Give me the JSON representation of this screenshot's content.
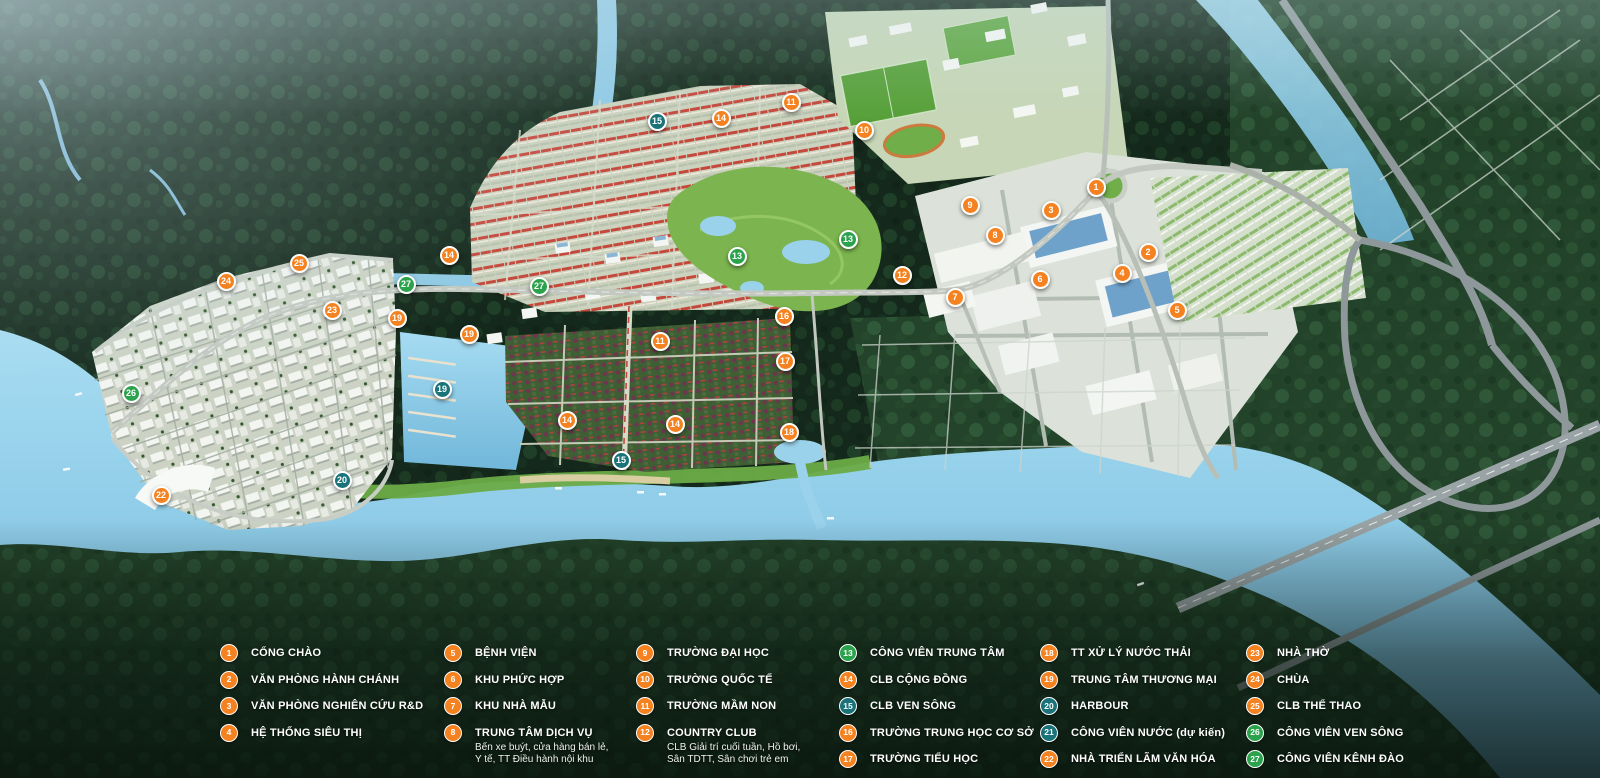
{
  "palette": {
    "orange": "#F58220",
    "green": "#2BA24C",
    "teal": "#1A7379",
    "water": "#8FC9E6",
    "forest_dark": "#16301F",
    "forest_mid": "#23432A"
  },
  "markers": [
    {
      "num": "1",
      "x": 1096,
      "y": 187,
      "color": "orange"
    },
    {
      "num": "2",
      "x": 1148,
      "y": 252,
      "color": "orange"
    },
    {
      "num": "3",
      "x": 1051,
      "y": 210,
      "color": "orange"
    },
    {
      "num": "4",
      "x": 1122,
      "y": 273,
      "color": "orange"
    },
    {
      "num": "5",
      "x": 1177,
      "y": 310,
      "color": "orange"
    },
    {
      "num": "6",
      "x": 1040,
      "y": 279,
      "color": "orange"
    },
    {
      "num": "7",
      "x": 955,
      "y": 297,
      "color": "orange"
    },
    {
      "num": "8",
      "x": 995,
      "y": 235,
      "color": "orange"
    },
    {
      "num": "9",
      "x": 970,
      "y": 205,
      "color": "orange"
    },
    {
      "num": "10",
      "x": 864,
      "y": 130,
      "color": "orange"
    },
    {
      "num": "11",
      "x": 791,
      "y": 102,
      "color": "orange"
    },
    {
      "num": "11",
      "x": 660,
      "y": 341,
      "color": "orange"
    },
    {
      "num": "12",
      "x": 902,
      "y": 275,
      "color": "orange"
    },
    {
      "num": "13",
      "x": 848,
      "y": 239,
      "color": "green"
    },
    {
      "num": "13",
      "x": 737,
      "y": 256,
      "color": "green"
    },
    {
      "num": "14",
      "x": 721,
      "y": 118,
      "color": "orange"
    },
    {
      "num": "14",
      "x": 449,
      "y": 255,
      "color": "orange"
    },
    {
      "num": "14",
      "x": 567,
      "y": 420,
      "color": "orange"
    },
    {
      "num": "14",
      "x": 675,
      "y": 424,
      "color": "orange"
    },
    {
      "num": "15",
      "x": 657,
      "y": 121,
      "color": "teal"
    },
    {
      "num": "15",
      "x": 621,
      "y": 460,
      "color": "teal"
    },
    {
      "num": "16",
      "x": 784,
      "y": 316,
      "color": "orange"
    },
    {
      "num": "17",
      "x": 785,
      "y": 361,
      "color": "orange"
    },
    {
      "num": "18",
      "x": 789,
      "y": 432,
      "color": "orange"
    },
    {
      "num": "19",
      "x": 397,
      "y": 318,
      "color": "orange"
    },
    {
      "num": "19",
      "x": 469,
      "y": 334,
      "color": "orange"
    },
    {
      "num": "19",
      "x": 442,
      "y": 389,
      "color": "teal"
    },
    {
      "num": "20",
      "x": 342,
      "y": 480,
      "color": "teal"
    },
    {
      "num": "22",
      "x": 161,
      "y": 495,
      "color": "orange"
    },
    {
      "num": "23",
      "x": 332,
      "y": 310,
      "color": "orange"
    },
    {
      "num": "24",
      "x": 226,
      "y": 281,
      "color": "orange"
    },
    {
      "num": "25",
      "x": 299,
      "y": 263,
      "color": "orange"
    },
    {
      "num": "26",
      "x": 131,
      "y": 393,
      "color": "green"
    },
    {
      "num": "27",
      "x": 406,
      "y": 284,
      "color": "green"
    },
    {
      "num": "27",
      "x": 539,
      "y": 286,
      "color": "green"
    }
  ],
  "legend": {
    "column_x": [
      220,
      444,
      636,
      839,
      1040,
      1246
    ],
    "columns": [
      {
        "items": [
          {
            "num": "1",
            "label": "CỔNG CHÀO",
            "color": "orange"
          },
          {
            "num": "2",
            "label": "VĂN PHÒNG HÀNH CHÁNH",
            "color": "orange"
          },
          {
            "num": "3",
            "label": "VĂN PHÒNG NGHIÊN CỨU R&D",
            "color": "orange"
          },
          {
            "num": "4",
            "label": "HỆ THỐNG SIÊU THỊ",
            "color": "orange"
          }
        ]
      },
      {
        "items": [
          {
            "num": "5",
            "label": "BỆNH VIỆN",
            "color": "orange"
          },
          {
            "num": "6",
            "label": "KHU PHỨC HỢP",
            "color": "orange"
          },
          {
            "num": "7",
            "label": "KHU NHÀ MẪU",
            "color": "orange"
          },
          {
            "num": "8",
            "label": "TRUNG TÂM DỊCH VỤ",
            "color": "orange",
            "sub": "Bến xe buýt, cửa hàng bán lẻ,\nY tế, TT Điều hành nội khu"
          }
        ]
      },
      {
        "items": [
          {
            "num": "9",
            "label": "TRƯỜNG ĐẠI HỌC",
            "color": "orange"
          },
          {
            "num": "10",
            "label": "TRƯỜNG QUỐC TẾ",
            "color": "orange"
          },
          {
            "num": "11",
            "label": "TRƯỜNG MẦM NON",
            "color": "orange"
          },
          {
            "num": "12",
            "label": "COUNTRY CLUB",
            "color": "orange",
            "sub": "CLB Giải trí cuối tuần, Hồ bơi,\nSân TDTT, Sân chơi trẻ em"
          }
        ]
      },
      {
        "items": [
          {
            "num": "13",
            "label": "CÔNG VIÊN TRUNG TÂM",
            "color": "green"
          },
          {
            "num": "14",
            "label": "CLB CỘNG ĐỒNG",
            "color": "orange"
          },
          {
            "num": "15",
            "label": "CLB VEN SÔNG",
            "color": "teal"
          },
          {
            "num": "16",
            "label": "TRƯỜNG TRUNG HỌC CƠ SỞ",
            "color": "orange"
          },
          {
            "num": "17",
            "label": "TRƯỜNG TIỂU HỌC",
            "color": "orange"
          }
        ]
      },
      {
        "items": [
          {
            "num": "18",
            "label": "TT XỬ LÝ NƯỚC THẢI",
            "color": "orange"
          },
          {
            "num": "19",
            "label": "TRUNG TÂM THƯƠNG MẠI",
            "color": "orange"
          },
          {
            "num": "20",
            "label": "HARBOUR",
            "color": "teal"
          },
          {
            "num": "21",
            "label": "CÔNG VIÊN NƯỚC (dự kiến)",
            "color": "teal"
          },
          {
            "num": "22",
            "label": "NHÀ TRIỂN LÃM VĂN HÓA",
            "color": "orange"
          }
        ]
      },
      {
        "items": [
          {
            "num": "23",
            "label": "NHÀ THỜ",
            "color": "orange"
          },
          {
            "num": "24",
            "label": "CHÙA",
            "color": "orange"
          },
          {
            "num": "25",
            "label": "CLB THỂ THAO",
            "color": "orange"
          },
          {
            "num": "26",
            "label": "CÔNG VIÊN VEN SÔNG",
            "color": "green"
          },
          {
            "num": "27",
            "label": "CÔNG VIÊN KÊNH ĐÀO",
            "color": "green"
          }
        ]
      }
    ]
  }
}
